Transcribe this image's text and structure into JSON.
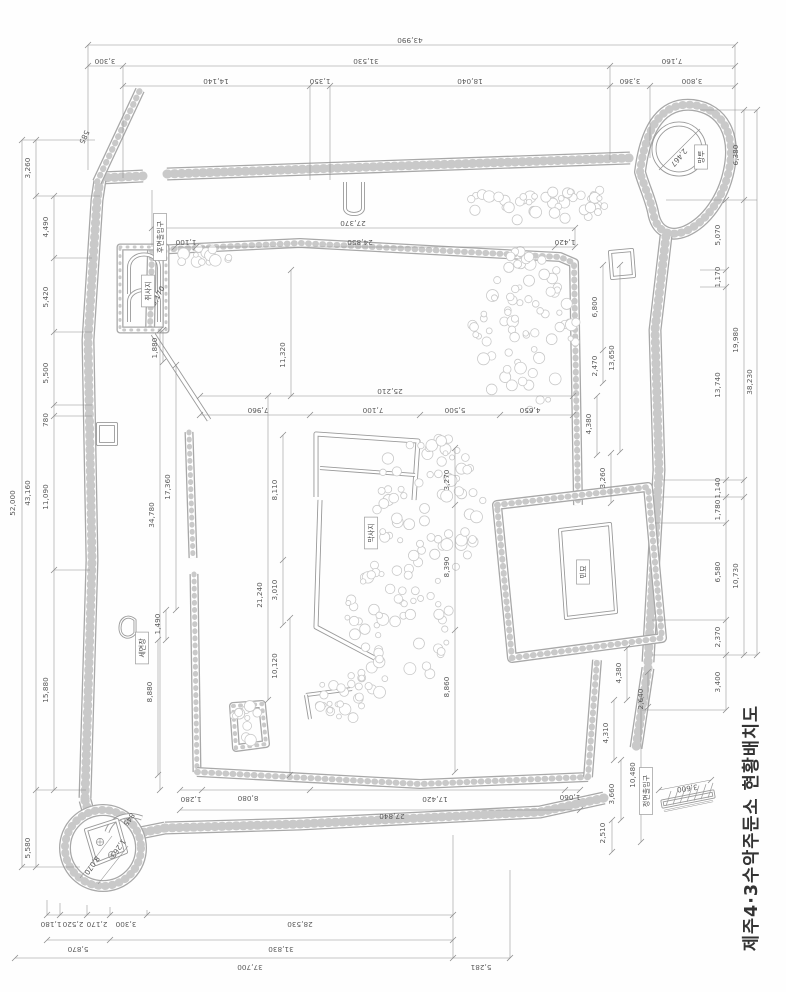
{
  "title": "제주4·3수악주둔소 현황배치도",
  "drawing": {
    "colors": {
      "line": "#8d8d8d",
      "wall_outline": "#a8a8a8",
      "pebble": "#c9c9c9",
      "text": "#555555",
      "paper": "#ffffff"
    },
    "feature_labels": [
      {
        "text": "후면출입구",
        "x": 160,
        "y": 237
      },
      {
        "text": "취사지",
        "x": 148,
        "y": 291
      },
      {
        "text": "세면장",
        "x": 142,
        "y": 648
      },
      {
        "text": "막사지",
        "x": 371,
        "y": 533
      },
      {
        "text": "민묘",
        "x": 583,
        "y": 572
      },
      {
        "text": "망루",
        "x": 701,
        "y": 157
      },
      {
        "text": "정면출입구",
        "x": 646,
        "y": 791
      }
    ],
    "dimension_labels": [
      {
        "t": "43,990",
        "x": 410,
        "y": 38,
        "r": 180
      },
      {
        "t": "3,300",
        "x": 105,
        "y": 59,
        "r": 180
      },
      {
        "t": "31,530",
        "x": 366,
        "y": 59,
        "r": 180
      },
      {
        "t": "7,160",
        "x": 672,
        "y": 59,
        "r": 180
      },
      {
        "t": "14,140",
        "x": 216,
        "y": 79,
        "r": 180
      },
      {
        "t": "1,350",
        "x": 320,
        "y": 79,
        "r": 180
      },
      {
        "t": "18,040",
        "x": 470,
        "y": 79,
        "r": 180
      },
      {
        "t": "3,360",
        "x": 630,
        "y": 79,
        "r": 180
      },
      {
        "t": "3,800",
        "x": 692,
        "y": 79,
        "r": 180
      },
      {
        "t": "52,000",
        "x": 15,
        "y": 503,
        "r": -90
      },
      {
        "t": "3,260",
        "x": 30,
        "y": 168,
        "r": -90
      },
      {
        "t": "43,160",
        "x": 30,
        "y": 493,
        "r": -90
      },
      {
        "t": "5,580",
        "x": 30,
        "y": 848,
        "r": -90
      },
      {
        "t": "4,490",
        "x": 48,
        "y": 227,
        "r": -90
      },
      {
        "t": "5,420",
        "x": 48,
        "y": 297,
        "r": -90
      },
      {
        "t": "5,500",
        "x": 48,
        "y": 373,
        "r": -90
      },
      {
        "t": "780",
        "x": 48,
        "y": 420,
        "r": -90
      },
      {
        "t": "11,090",
        "x": 48,
        "y": 497,
        "r": -90
      },
      {
        "t": "15,880",
        "x": 48,
        "y": 690,
        "r": -90
      },
      {
        "t": "5,070",
        "x": 720,
        "y": 235,
        "r": -90
      },
      {
        "t": "1,170",
        "x": 720,
        "y": 277,
        "r": -90
      },
      {
        "t": "13,740",
        "x": 720,
        "y": 385,
        "r": -90
      },
      {
        "t": "1,140",
        "x": 720,
        "y": 488,
        "r": -90
      },
      {
        "t": "1,780",
        "x": 720,
        "y": 510,
        "r": -90
      },
      {
        "t": "6,580",
        "x": 720,
        "y": 572,
        "r": -90
      },
      {
        "t": "2,370",
        "x": 720,
        "y": 637,
        "r": -90
      },
      {
        "t": "3,400",
        "x": 720,
        "y": 682,
        "r": -90
      },
      {
        "t": "6,380",
        "x": 738,
        "y": 155,
        "r": -90
      },
      {
        "t": "19,980",
        "x": 738,
        "y": 340,
        "r": -90
      },
      {
        "t": "10,730",
        "x": 738,
        "y": 576,
        "r": -90
      },
      {
        "t": "38,230",
        "x": 752,
        "y": 382,
        "r": -90
      },
      {
        "t": "1,180",
        "x": 51,
        "y": 922,
        "r": 180
      },
      {
        "t": "2,520",
        "x": 73,
        "y": 922,
        "r": 180
      },
      {
        "t": "2,170",
        "x": 97,
        "y": 922,
        "r": 180
      },
      {
        "t": "3,300",
        "x": 126,
        "y": 922,
        "r": 180
      },
      {
        "t": "28,530",
        "x": 300,
        "y": 922,
        "r": 180
      },
      {
        "t": "5,870",
        "x": 78,
        "y": 947,
        "r": 180
      },
      {
        "t": "31,830",
        "x": 281,
        "y": 947,
        "r": 180
      },
      {
        "t": "37,700",
        "x": 250,
        "y": 965,
        "r": 180
      },
      {
        "t": "5,281",
        "x": 481,
        "y": 965,
        "r": 180
      },
      {
        "t": "27,370",
        "x": 353,
        "y": 221,
        "r": 180
      },
      {
        "t": "1,100",
        "x": 186,
        "y": 240,
        "r": 180
      },
      {
        "t": "24,850",
        "x": 360,
        "y": 240,
        "r": 180
      },
      {
        "t": "1,420",
        "x": 565,
        "y": 240,
        "r": 180
      },
      {
        "t": "11,320",
        "x": 285,
        "y": 355,
        "r": -90
      },
      {
        "t": "5,170",
        "x": 160,
        "y": 297,
        "r": -62
      },
      {
        "t": "1,880",
        "x": 157,
        "y": 348,
        "r": -90
      },
      {
        "t": "6,800",
        "x": 597,
        "y": 307,
        "r": -90
      },
      {
        "t": "13,650",
        "x": 614,
        "y": 358,
        "r": -90
      },
      {
        "t": "2,470",
        "x": 597,
        "y": 366,
        "r": -90
      },
      {
        "t": "25,210",
        "x": 390,
        "y": 389,
        "r": 180
      },
      {
        "t": "7,960",
        "x": 258,
        "y": 408,
        "r": 180
      },
      {
        "t": "7,100",
        "x": 373,
        "y": 408,
        "r": 180
      },
      {
        "t": "5,500",
        "x": 455,
        "y": 408,
        "r": 180
      },
      {
        "t": "4,650",
        "x": 530,
        "y": 408,
        "r": 180
      },
      {
        "t": "4,380",
        "x": 591,
        "y": 424,
        "r": -90
      },
      {
        "t": "3,260",
        "x": 605,
        "y": 478,
        "r": -90
      },
      {
        "t": "3,270",
        "x": 449,
        "y": 480,
        "r": -90
      },
      {
        "t": "8,390",
        "x": 449,
        "y": 567,
        "r": -90
      },
      {
        "t": "8,860",
        "x": 449,
        "y": 687,
        "r": -90
      },
      {
        "t": "8,110",
        "x": 277,
        "y": 490,
        "r": -90
      },
      {
        "t": "3,010",
        "x": 277,
        "y": 590,
        "r": -90
      },
      {
        "t": "21,240",
        "x": 262,
        "y": 595,
        "r": -90
      },
      {
        "t": "17,360",
        "x": 170,
        "y": 487,
        "r": -90
      },
      {
        "t": "34,780",
        "x": 154,
        "y": 515,
        "r": -90
      },
      {
        "t": "1,490",
        "x": 160,
        "y": 624,
        "r": -90
      },
      {
        "t": "8,880",
        "x": 152,
        "y": 692,
        "r": -90
      },
      {
        "t": "10,120",
        "x": 277,
        "y": 666,
        "r": -90
      },
      {
        "t": "4,380",
        "x": 621,
        "y": 673,
        "r": -90
      },
      {
        "t": "2,640",
        "x": 643,
        "y": 699,
        "r": -90
      },
      {
        "t": "4,310",
        "x": 608,
        "y": 733,
        "r": -90
      },
      {
        "t": "10,480",
        "x": 635,
        "y": 775,
        "r": -90
      },
      {
        "t": "3,660",
        "x": 614,
        "y": 794,
        "r": -90
      },
      {
        "t": "2,510",
        "x": 605,
        "y": 833,
        "r": -90
      },
      {
        "t": "1,280",
        "x": 191,
        "y": 797,
        "r": 180
      },
      {
        "t": "8,080",
        "x": 248,
        "y": 796,
        "r": 180
      },
      {
        "t": "17,420",
        "x": 435,
        "y": 797,
        "r": 180
      },
      {
        "t": "1,060",
        "x": 570,
        "y": 795,
        "r": 180
      },
      {
        "t": "27,840",
        "x": 392,
        "y": 814,
        "r": 180
      },
      {
        "t": "3,600",
        "x": 687,
        "y": 786,
        "r": 172
      },
      {
        "t": "2,467",
        "x": 677,
        "y": 156,
        "r": 130
      },
      {
        "t": "585",
        "x": 82,
        "y": 136,
        "r": 115
      },
      {
        "t": "8,070",
        "x": 90,
        "y": 864,
        "r": 125
      },
      {
        "t": "1,263",
        "x": 116,
        "y": 847,
        "r": 125
      },
      {
        "t": "845",
        "x": 127,
        "y": 818,
        "r": 125
      }
    ]
  }
}
